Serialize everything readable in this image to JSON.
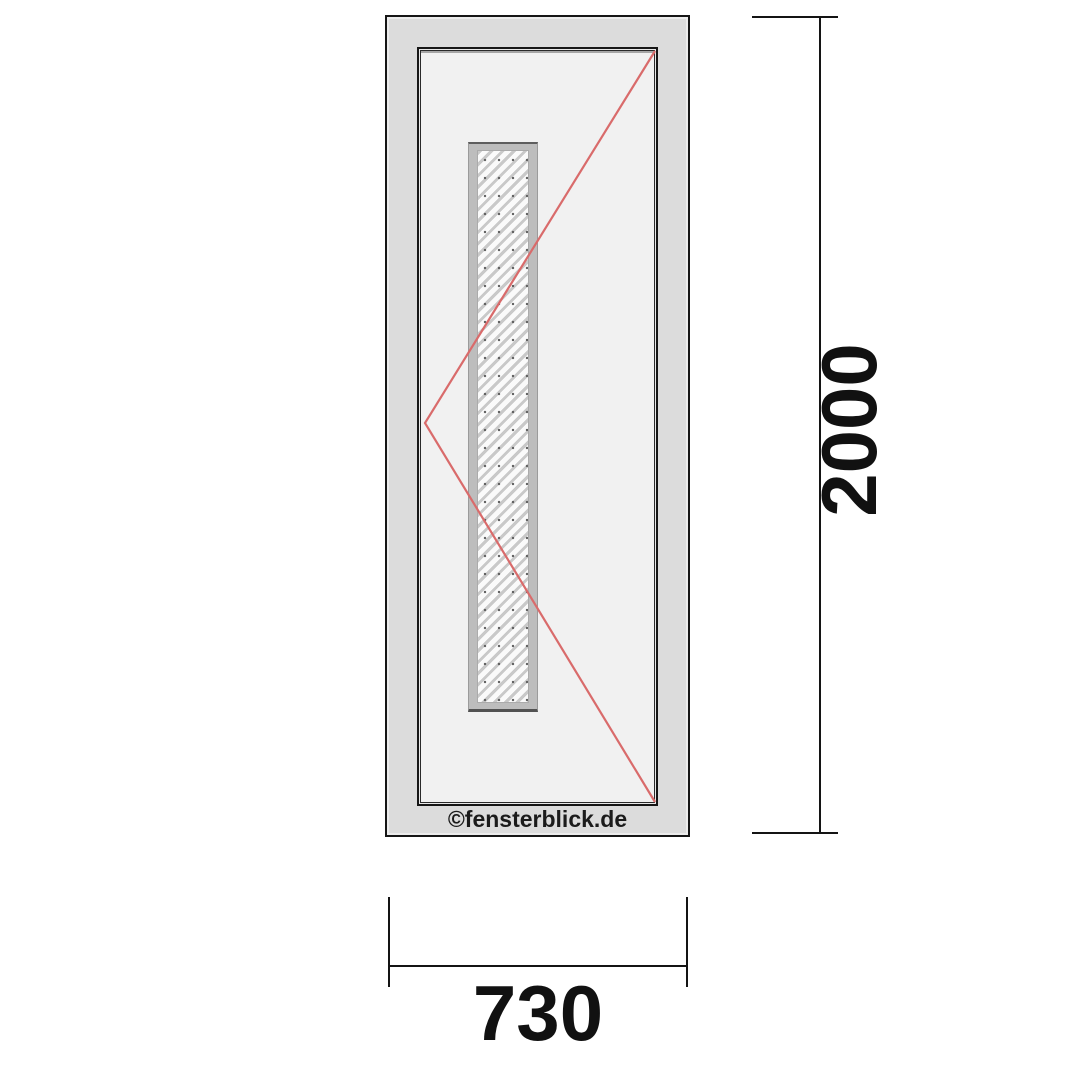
{
  "watermark": {
    "text": "©fensterblick.de"
  },
  "dimensions": {
    "height": {
      "value": "2000",
      "unit": "mm"
    },
    "width": {
      "value": "730",
      "unit": "mm"
    }
  },
  "door": {
    "opening_indicator": "turn-opening-direction-lines",
    "glazing": "vertical-glass-strip-hatched"
  },
  "colors": {
    "outline": "#161616",
    "frame_fill": "#dcdcdc",
    "sash_fill": "#f1f1f1",
    "glass_frame_fill": "#bdbdbd",
    "hatch_line": "#c9c9c9",
    "opening_line": "#d96b6b",
    "dimension_line": "#141414"
  }
}
